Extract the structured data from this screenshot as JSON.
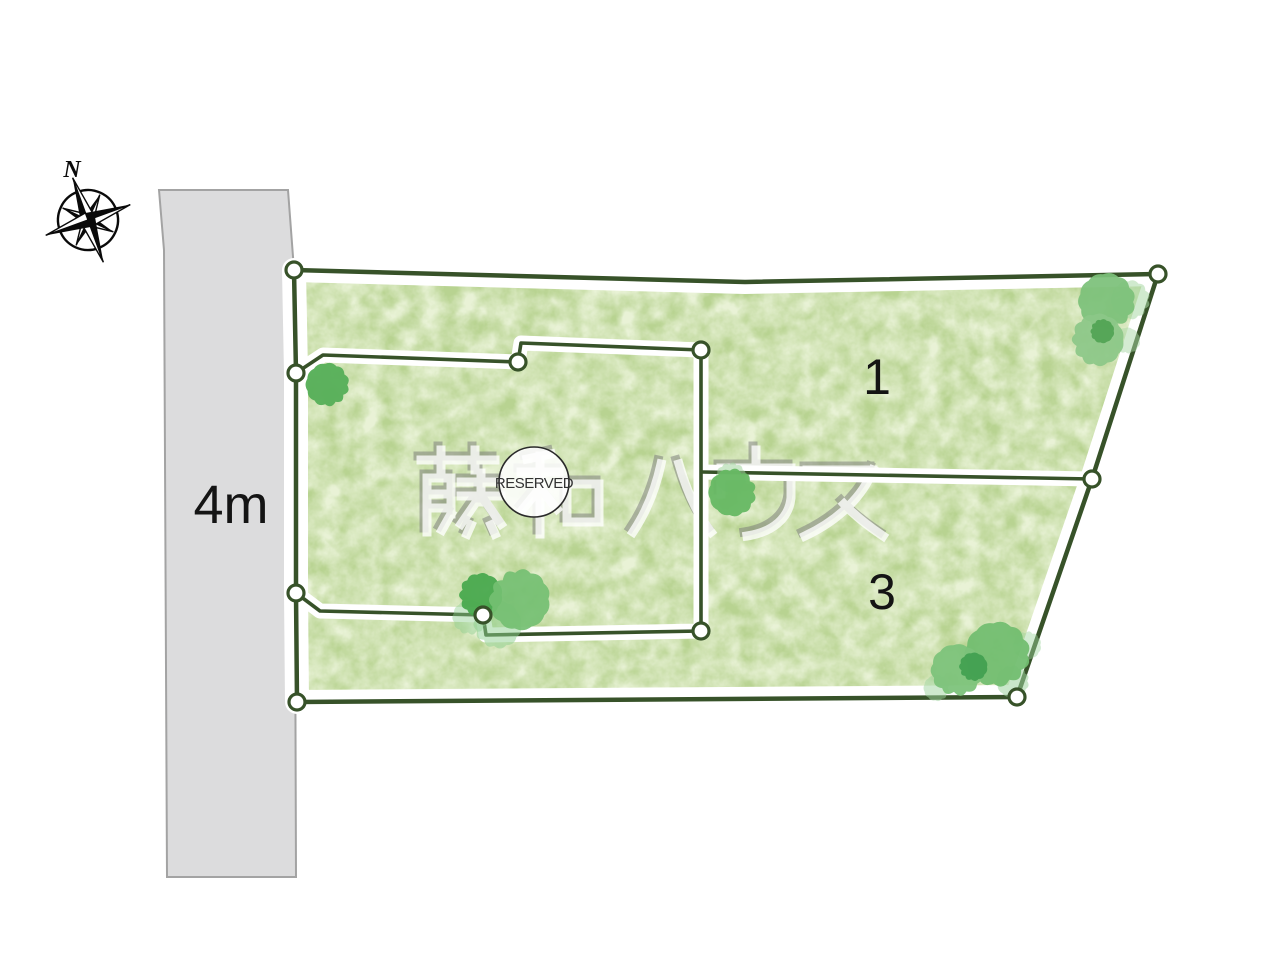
{
  "diagram_type": "real-estate lot layout site plan",
  "road": {
    "width_label": "4m"
  },
  "compass": {
    "north_label": "N"
  },
  "lots": {
    "lot1_label": "1",
    "lot3_label": "3"
  },
  "reserved_badge": {
    "label": "RESERVED"
  },
  "watermark": {
    "text": "藤和ハウス"
  },
  "colors": {
    "boundary_line": "#375229",
    "grass": "#b8d391",
    "grass_light": "#cfe3ab",
    "road_fill": "#dcdcdd",
    "road_edge": "#a3a3a3",
    "band_white": "#ffffff",
    "vertex_fill": "#ffffff",
    "label_color": "#141414"
  },
  "site_plan": {
    "canvas": {
      "w": 1280,
      "h": 980
    },
    "road_points": "159,190 288,190 294,270 296,877 167,877 164,250",
    "road_label_pos": [
      231,
      523
    ],
    "outer_polygon": [
      [
        294,
        270
      ],
      [
        745,
        282
      ],
      [
        1158,
        274
      ],
      [
        1092,
        479
      ],
      [
        1017,
        697
      ],
      [
        297,
        702
      ],
      [
        296,
        593
      ],
      [
        296,
        373
      ]
    ],
    "inner_boundary": [
      [
        296,
        373
      ],
      [
        323,
        355
      ],
      [
        518,
        362
      ],
      [
        521,
        343
      ],
      [
        701,
        350
      ],
      [
        701,
        631
      ],
      [
        486,
        635
      ],
      [
        483,
        615
      ],
      [
        320,
        611
      ],
      [
        296,
        593
      ]
    ],
    "divider": [
      [
        702,
        472
      ],
      [
        1092,
        479
      ]
    ],
    "vertices": [
      [
        294,
        270
      ],
      [
        1158,
        274
      ],
      [
        1092,
        479
      ],
      [
        1017,
        697
      ],
      [
        297,
        702
      ],
      [
        296,
        593
      ],
      [
        296,
        373
      ],
      [
        518,
        362
      ],
      [
        701,
        350
      ],
      [
        701,
        631
      ],
      [
        483,
        615
      ]
    ],
    "lot1_label_pos": [
      877,
      394
    ],
    "lot3_label_pos": [
      882,
      609
    ],
    "reserved_circle": {
      "cx": 534,
      "cy": 482,
      "r": 35
    },
    "reserved_text_pos": [
      534,
      488
    ],
    "watermark_origin": {
      "x": 413,
      "y": 446
    },
    "compass_center": [
      88,
      220
    ],
    "north_label_pos": [
      72,
      177
    ],
    "trees": [
      {
        "cx": 328,
        "cy": 385,
        "r": 20,
        "color": "#58b05a",
        "o": 0.97,
        "seed": 1
      },
      {
        "cx": 470,
        "cy": 618,
        "r": 16,
        "color": "#8ecf90",
        "o": 0.45,
        "seed": 2
      },
      {
        "cx": 497,
        "cy": 625,
        "r": 22,
        "color": "#8ecf90",
        "o": 0.5,
        "seed": 3
      },
      {
        "cx": 480,
        "cy": 595,
        "r": 20,
        "color": "#49a94e",
        "o": 0.95,
        "seed": 4
      },
      {
        "cx": 519,
        "cy": 599,
        "r": 28,
        "color": "#74bf72",
        "o": 0.92,
        "seed": 5
      },
      {
        "cx": 731,
        "cy": 477,
        "r": 14,
        "color": "#a0d49c",
        "o": 0.55,
        "seed": 6
      },
      {
        "cx": 733,
        "cy": 492,
        "r": 22,
        "color": "#66b863",
        "o": 0.95,
        "seed": 7
      },
      {
        "cx": 1131,
        "cy": 300,
        "r": 18,
        "color": "#a9d8a5",
        "o": 0.55,
        "seed": 8
      },
      {
        "cx": 1107,
        "cy": 302,
        "r": 26,
        "color": "#7cc17a",
        "o": 0.93,
        "seed": 9
      },
      {
        "cx": 1127,
        "cy": 341,
        "r": 12,
        "color": "#a9d8a5",
        "o": 0.5,
        "seed": 10
      },
      {
        "cx": 1097,
        "cy": 340,
        "r": 24,
        "color": "#8cc788",
        "o": 0.93,
        "seed": 11
      },
      {
        "cx": 1102,
        "cy": 331,
        "r": 11,
        "color": "#4ba04f",
        "o": 0.85,
        "seed": 12
      },
      {
        "cx": 1027,
        "cy": 645,
        "r": 13,
        "color": "#9ed49e",
        "o": 0.45,
        "seed": 13
      },
      {
        "cx": 1013,
        "cy": 681,
        "r": 15,
        "color": "#9ed49e",
        "o": 0.55,
        "seed": 14
      },
      {
        "cx": 937,
        "cy": 688,
        "r": 12,
        "color": "#9ed49e",
        "o": 0.5,
        "seed": 15
      },
      {
        "cx": 998,
        "cy": 655,
        "r": 30,
        "color": "#72bd70",
        "o": 0.94,
        "seed": 16
      },
      {
        "cx": 957,
        "cy": 671,
        "r": 24,
        "color": "#7cc27a",
        "o": 0.94,
        "seed": 17
      },
      {
        "cx": 973,
        "cy": 667,
        "r": 13,
        "color": "#3f9e4f",
        "o": 0.9,
        "seed": 18
      }
    ]
  }
}
